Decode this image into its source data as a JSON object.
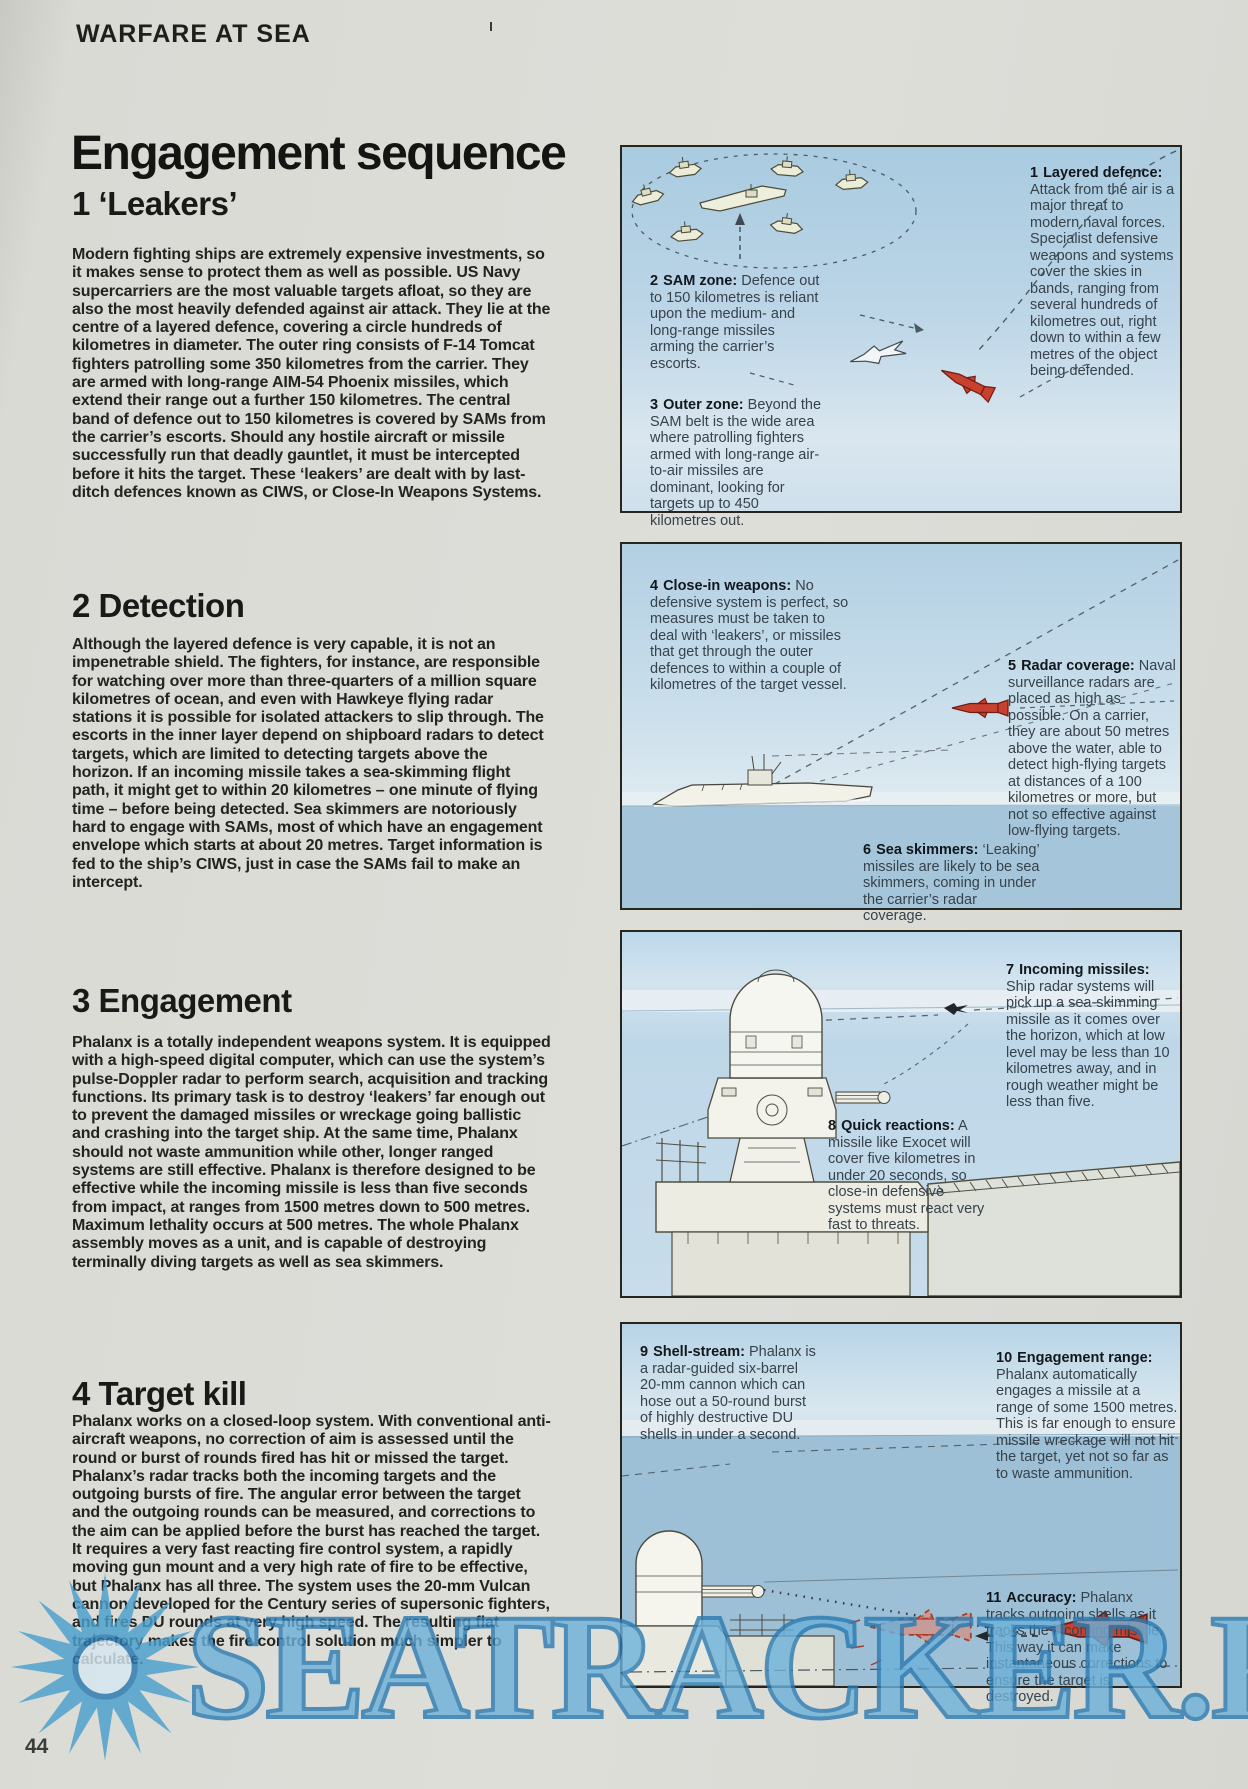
{
  "page": {
    "kicker": "WARFARE AT SEA",
    "page_number": "44",
    "watermark": "SEATRACKER.RU"
  },
  "article": {
    "title": "Engagement sequence",
    "sections": [
      {
        "heading": "1 ‘Leakers’",
        "body": "Modern fighting ships are extremely expensive investments, so it makes sense to protect them as well as possible. US Navy supercarriers are the most valuable targets afloat, so they are also the most heavily defended against air attack. They lie at the centre of a layered defence, covering a circle hundreds of kilometres in diameter. The outer ring consists of F-14 Tomcat fighters patrolling some 350 kilometres from the carrier. They are armed with long-range AIM-54 Phoenix missiles, which extend their range out a further 150 kilometres. The central band of defence out to 150 kilometres is covered by SAMs from the carrier’s escorts. Should any hostile aircraft or missile successfully run that deadly gauntlet, it must be intercepted before it hits the target. These ‘leakers’ are dealt with by last-ditch defences known as CIWS, or Close-In Weapons Systems."
      },
      {
        "heading": "2 Detection",
        "body": "Although the layered defence is very capable, it is not an impenetrable shield. The fighters, for instance, are responsible for watching over more than three-quarters of a million square kilometres of ocean, and even with Hawkeye flying radar stations it is possible for isolated attackers to slip through. The escorts in the inner layer depend on shipboard radars to detect targets, which are limited to detecting targets above the horizon. If an incoming missile takes a sea-skimming flight path, it might get to within 20 kilometres – one minute of flying time – before being detected. Sea skimmers are notoriously hard to engage with SAMs, most of which have an engagement envelope which starts at about 20 metres. Target information is fed to the ship’s CIWS, just in case the SAMs fail to make an intercept."
      },
      {
        "heading": "3 Engagement",
        "body": "Phalanx is a totally independent weapons system. It is equipped with a high-speed digital computer, which can use the system’s pulse-Doppler radar to perform search, acquisition and tracking functions. Its primary task is to destroy ‘leakers’ far enough out to prevent the damaged missiles or wreckage going ballistic and crashing into the target ship. At the same time, Phalanx should not waste ammunition while other, longer ranged systems are still effective. Phalanx is therefore designed to be effective while the incoming missile is less than five seconds from impact, at ranges from 1500 metres down to 500 metres. Maximum lethality occurs at 500 metres. The whole Phalanx assembly moves as a unit, and is capable of destroying terminally diving targets as well as sea skimmers."
      },
      {
        "heading": "4 Target kill",
        "body": "Phalanx works on a closed-loop system. With conventional anti-aircraft weapons, no correction of aim is assessed until the round or burst of rounds fired has hit or missed the target. Phalanx’s radar tracks both the incoming targets and the outgoing bursts of fire. The angular error between the target and the outgoing rounds can be measured, and corrections to the aim can be applied before the burst has reached the target. It requires a very fast reacting fire control system, a rapidly moving gun mount and a very high rate of fire to be effective, but Phalanx has all three. The system uses the 20-mm Vulcan cannon developed for the Century series of supersonic fighters, and fires DU rounds at very high speed. The resulting flat trajectory makes the fire control solution much simpler to calculate."
      }
    ]
  },
  "panels": [
    {
      "name": "layered-defence-diagram",
      "callouts": [
        {
          "num": "1",
          "lead": "Layered defence:",
          "text": "Attack from the air is a major threat to modern naval forces. Specialist defensive weapons and systems cover the skies in bands, ranging from several hundreds of kilometres out, right down to within a few metres of the object being defended."
        },
        {
          "num": "2",
          "lead": "SAM zone:",
          "text": "Defence out to 150 kilometres is reliant upon the medium- and long-range missiles arming the carrier’s escorts."
        },
        {
          "num": "3",
          "lead": "Outer zone:",
          "text": "Beyond the SAM belt is the wide area where patrolling fighters armed with long-range air-to-air missiles are dominant, looking for targets up to 450 kilometres out."
        }
      ]
    },
    {
      "name": "detection-diagram",
      "callouts": [
        {
          "num": "4",
          "lead": "Close-in weapons:",
          "text": "No defensive system is perfect, so measures must be taken to deal with ‘leakers’, or missiles that get through the outer defences to within a couple of kilometres of the target vessel."
        },
        {
          "num": "5",
          "lead": "Radar coverage:",
          "text": "Naval surveillance radars are placed as high as possible. On a carrier, they are about 50 metres above the water, able to detect high-flying targets at distances of a 100 kilometres or more, but not so effective against low-flying targets."
        },
        {
          "num": "6",
          "lead": "Sea skimmers:",
          "text": "‘Leaking’ missiles are likely to be sea skimmers, coming in under the carrier’s radar coverage."
        }
      ]
    },
    {
      "name": "engagement-diagram",
      "callouts": [
        {
          "num": "7",
          "lead": "Incoming missiles:",
          "text": "Ship radar systems will pick up a sea-skimming missile as it comes over the horizon, which at low level may be less than 10 kilometres away, and in rough weather might be less than five."
        },
        {
          "num": "8",
          "lead": "Quick reactions:",
          "text": "A missile like Exocet will cover five kilometres in under 20 seconds, so close-in defensive systems must react very fast to threats."
        }
      ]
    },
    {
      "name": "target-kill-diagram",
      "callouts": [
        {
          "num": "9",
          "lead": "Shell-stream:",
          "text": "Phalanx is a radar-guided six-barrel 20-mm cannon which can hose out a 50-round burst of highly destructive DU shells in under a second."
        },
        {
          "num": "10",
          "lead": "Engagement range:",
          "text": "Phalanx automatically engages a missile at a range of some 1500 metres. This is far enough to ensure missile wreckage will not hit the target, yet not so far as to waste ammunition."
        },
        {
          "num": "11",
          "lead": "Accuracy:",
          "text": "Phalanx tracks outgoing shells as it tracks the incoming missile. This way it can make instantaneous corrections to ensure the target is destroyed."
        }
      ]
    }
  ],
  "colors": {
    "paper": "#dadad5",
    "panel_border": "#26261f",
    "sky_blue": "#b7d3e5",
    "sea_blue": "#9dc0d6",
    "missile_red": "#c8402e",
    "watermark_blue": "#57a6d2",
    "body_text": "#232321",
    "callout_text": "#37424b"
  }
}
